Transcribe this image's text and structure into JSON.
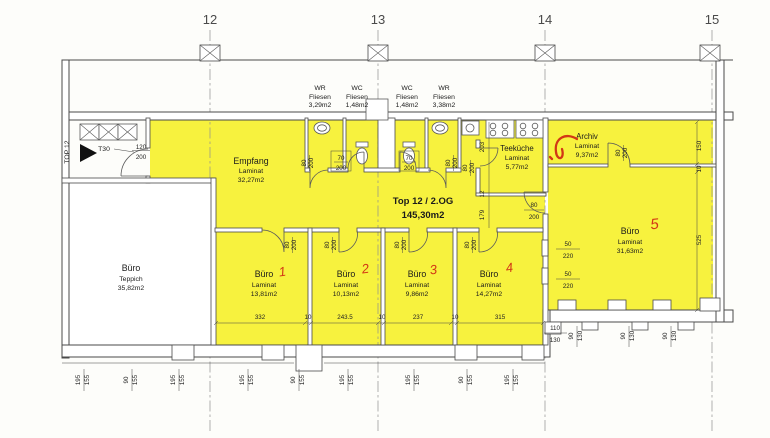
{
  "colors": {
    "highlight": "#f7f23e",
    "wall": "#4a4a4a",
    "text": "#1b1b1b",
    "red_annotation": "#d23715",
    "grid": "#909090"
  },
  "grid_labels": [
    "12",
    "13",
    "14",
    "15"
  ],
  "unit_label": {
    "title": "Top 12 / 2.OG",
    "area": "145,30m2"
  },
  "entrance": {
    "unit": "TOP 12",
    "door_type": "T30"
  },
  "rooms": {
    "wr_left": {
      "name": "WR",
      "floor": "Fliesen",
      "area": "3,29m2"
    },
    "wc_left": {
      "name": "WC",
      "floor": "Fliesen",
      "area": "1,48m2"
    },
    "wc_right": {
      "name": "WC",
      "floor": "Fliesen",
      "area": "1,48m2"
    },
    "wr_right": {
      "name": "WR",
      "floor": "Fliesen",
      "area": "3,38m2"
    },
    "empfang": {
      "name": "Empfang",
      "floor": "Laminat",
      "area": "32,27m2"
    },
    "teekueche": {
      "name": "Teeküche",
      "floor": "Laminat",
      "area": "5,77m2"
    },
    "archiv": {
      "name": "Archiv",
      "floor": "Laminat",
      "area": "9,37m2"
    },
    "buero_teppich": {
      "name": "Büro",
      "floor": "Teppich",
      "area": "35,82m2"
    },
    "buero1": {
      "name": "Büro",
      "no": "1",
      "floor": "Laminat",
      "area": "13,81m2"
    },
    "buero2": {
      "name": "Büro",
      "no": "2",
      "floor": "Laminat",
      "area": "10,13m2"
    },
    "buero3": {
      "name": "Büro",
      "no": "3",
      "floor": "Laminat",
      "area": "9,86m2"
    },
    "buero4": {
      "name": "Büro",
      "no": "4",
      "floor": "Laminat",
      "area": "14,27m2"
    },
    "buero5": {
      "name": "Büro",
      "no": "5",
      "floor": "Laminat",
      "area": "31,63m2"
    }
  },
  "dims": {
    "chain": [
      "332",
      "10",
      "243.5",
      "10",
      "237",
      "10",
      "315"
    ],
    "right": [
      "150",
      "10",
      "525"
    ],
    "v50": "50",
    "v220": "220",
    "v110": "110",
    "v130": "130",
    "v90": "90",
    "v195": "195",
    "v155": "155",
    "v80": "80",
    "v70": "70",
    "v120": "120",
    "v200": "200",
    "v203": "203",
    "v12": "12",
    "v179": "179"
  }
}
